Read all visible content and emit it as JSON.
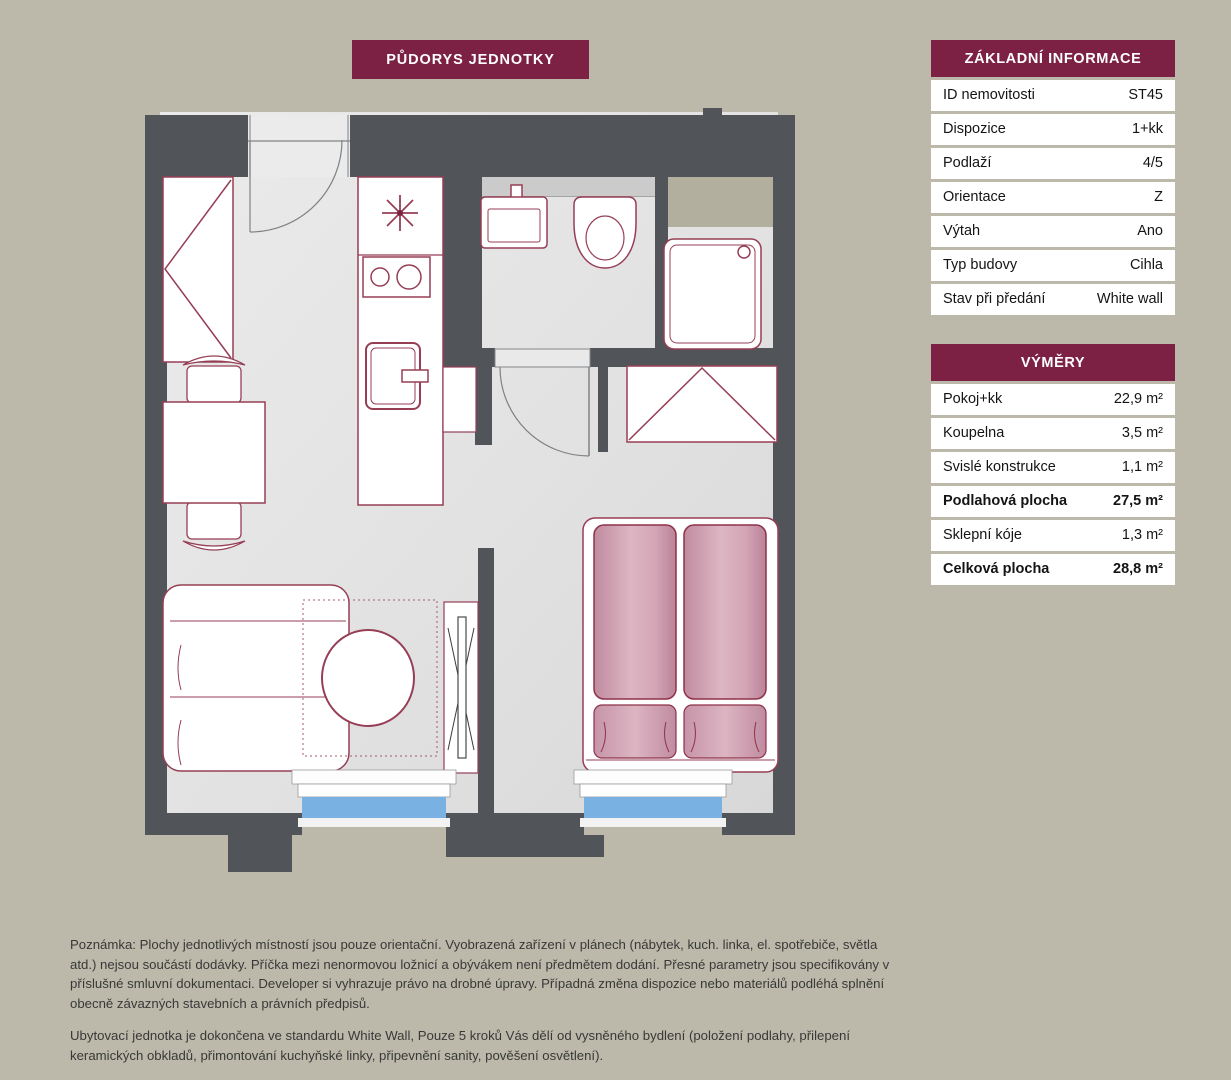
{
  "title_banner": "PŮDORYS JEDNOTKY",
  "info_table": {
    "header": "ZÁKLADNÍ INFORMACE",
    "rows": [
      {
        "label": "ID nemovitosti",
        "value": "ST45"
      },
      {
        "label": "Dispozice",
        "value": "1+kk"
      },
      {
        "label": "Podlaží",
        "value": "4/5"
      },
      {
        "label": "Orientace",
        "value": "Z"
      },
      {
        "label": "Výtah",
        "value": "Ano"
      },
      {
        "label": "Typ budovy",
        "value": "Cihla"
      },
      {
        "label": "Stav při předání",
        "value": "White wall"
      }
    ]
  },
  "areas_table": {
    "header": "VÝMĚRY",
    "rows": [
      {
        "label": "Pokoj+kk",
        "value": "22,9 m²"
      },
      {
        "label": "Koupelna",
        "value": "3,5 m²"
      },
      {
        "label": "Svislé konstrukce",
        "value": "1,1 m²"
      },
      {
        "label": "Podlahová plocha",
        "value": "27,5 m²"
      },
      {
        "label": "Sklepní kóje",
        "value": "1,3 m²"
      },
      {
        "label": "Celková plocha",
        "value": "28,8 m²"
      }
    ]
  },
  "notes": {
    "paragraph1": "Poznámka: Plochy jednotlivých místností jsou pouze orientační. Vyobrazená zařízení v plánech (nábytek, kuch. linka, el. spotřebiče, světla atd.) nejsou součástí dodávky. Příčka mezi nenormovou ložnicí a obývákem není předmětem dodání. Přesné parametry jsou specifikovány v příslušné smluvní dokumentaci. Developer si vyhrazuje právo na drobné úpravy. Případná změna dispozice nebo materiálů podléhá splnění obecně závazných stavebních a právních předpisů.",
    "paragraph2": "Ubytovací jednotka je dokončena ve standardu White Wall, Pouze 5 kroků Vás dělí od vysněného bydlení (položení podlahy, přilepení keramických obkladů, přimontování kuchyňské linky, připevnění sanity, pověšení osvětlení)."
  },
  "colors": {
    "accent_maroon": "#7c2143",
    "furniture_outline": "#963e55",
    "wall": "#515458",
    "floor": "#e3e3e3",
    "window_glass": "#79b1e2",
    "bed_pink": "#d3a5b5",
    "shaft_beige": "#b2af9f",
    "background": "#bcb9aa"
  }
}
